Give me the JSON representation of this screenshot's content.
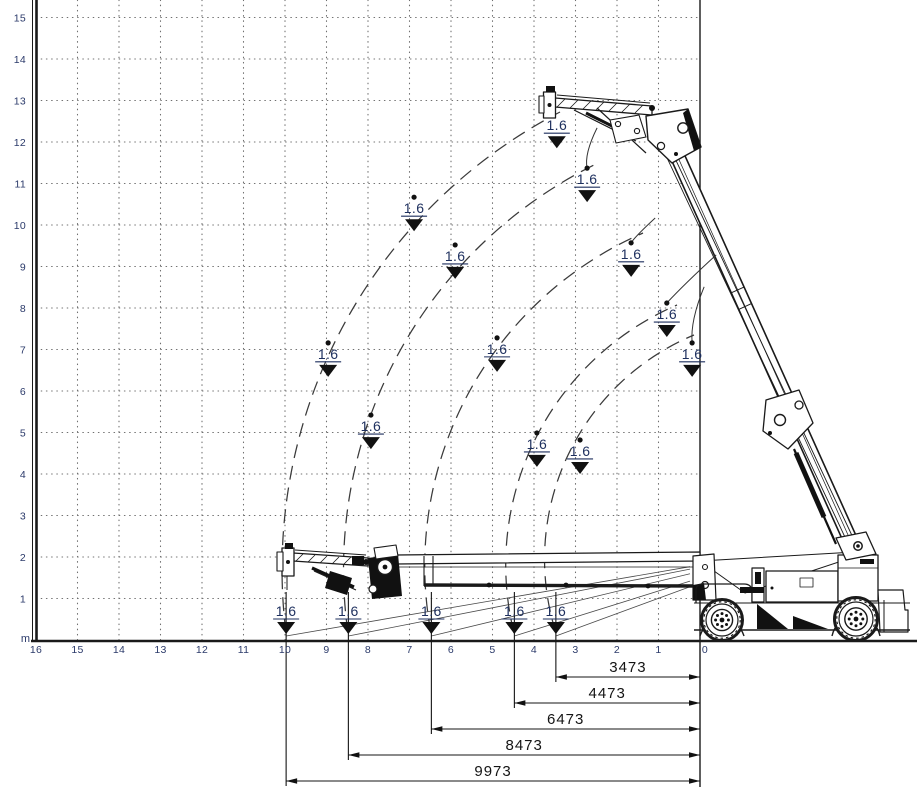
{
  "axes": {
    "unit_label": "m",
    "x_ticks": [
      "16",
      "15",
      "14",
      "13",
      "12",
      "11",
      "10",
      "9",
      "8",
      "7",
      "6",
      "5",
      "4",
      "3",
      "2",
      "1",
      "0"
    ],
    "y_ticks": [
      "15",
      "14",
      "13",
      "12",
      "11",
      "10",
      "9",
      "8",
      "7",
      "6",
      "5",
      "4",
      "3",
      "2",
      "1"
    ]
  },
  "layout": {
    "px_per_m": 41.5,
    "origin_x": 700,
    "origin_y": 640
  },
  "capacity_markers": [
    {
      "x_m": 3.45,
      "y_m": 12.67,
      "label": "1.6",
      "variant": "plain"
    },
    {
      "x_m": 2.72,
      "y_m": 11.37,
      "label": "1.6",
      "variant": "leader",
      "from_x_m": 2.48,
      "from_y_m": 12.34
    },
    {
      "x_m": 1.66,
      "y_m": 9.57,
      "label": "1.6",
      "variant": "leader",
      "from_x_m": 1.08,
      "from_y_m": 10.17
    },
    {
      "x_m": 0.8,
      "y_m": 8.12,
      "label": "1.6",
      "variant": "leader",
      "from_x_m": -0.39,
      "from_y_m": 9.28
    },
    {
      "x_m": 0.19,
      "y_m": 7.16,
      "label": "1.6",
      "variant": "leader",
      "from_x_m": -0.1,
      "from_y_m": 8.51
    },
    {
      "x_m": 6.89,
      "y_m": 10.67,
      "label": "1.6",
      "variant": "dot"
    },
    {
      "x_m": 5.9,
      "y_m": 9.52,
      "label": "1.6",
      "variant": "dot"
    },
    {
      "x_m": 8.96,
      "y_m": 7.16,
      "label": "1.6",
      "variant": "dot"
    },
    {
      "x_m": 4.89,
      "y_m": 7.28,
      "label": "1.6",
      "variant": "dot"
    },
    {
      "x_m": 7.93,
      "y_m": 5.42,
      "label": "1.6",
      "variant": "dot"
    },
    {
      "x_m": 3.93,
      "y_m": 4.99,
      "label": "1.6",
      "variant": "dot"
    },
    {
      "x_m": 2.89,
      "y_m": 4.82,
      "label": "1.6",
      "variant": "dot"
    },
    {
      "x_m": 9.973,
      "y_m": 0,
      "label": "1.6",
      "variant": "bottom"
    },
    {
      "x_m": 8.473,
      "y_m": 0,
      "label": "1.6",
      "variant": "bottom"
    },
    {
      "x_m": 6.473,
      "y_m": 0,
      "label": "1.6",
      "variant": "bottom"
    },
    {
      "x_m": 4.473,
      "y_m": 0,
      "label": "1.6",
      "variant": "bottom"
    },
    {
      "x_m": 3.473,
      "y_m": 0,
      "label": "1.6",
      "variant": "bottom"
    }
  ],
  "outreach_dimensions": [
    {
      "label": "3473",
      "mm": 3473
    },
    {
      "label": "4473",
      "mm": 4473
    },
    {
      "label": "6473",
      "mm": 6473
    },
    {
      "label": "8473",
      "mm": 8473
    },
    {
      "label": "9973",
      "mm": 9973
    }
  ],
  "chart_data": {
    "type": "scatter",
    "title": "",
    "x_axis": {
      "unit": "m",
      "range": [
        0,
        16
      ],
      "direction": "right-to-left",
      "grid": true
    },
    "y_axis": {
      "unit": "m",
      "range": [
        0,
        15
      ],
      "grid": true
    },
    "series": [
      {
        "name": "rated capacity (t) at jib-tip position",
        "points": [
          {
            "x_m": 3.45,
            "y_m": 12.67,
            "value": 1.6
          },
          {
            "x_m": 2.72,
            "y_m": 11.37,
            "value": 1.6
          },
          {
            "x_m": 1.66,
            "y_m": 9.57,
            "value": 1.6
          },
          {
            "x_m": 0.8,
            "y_m": 8.12,
            "value": 1.6
          },
          {
            "x_m": 0.19,
            "y_m": 7.16,
            "value": 1.6
          },
          {
            "x_m": 6.89,
            "y_m": 10.67,
            "value": 1.6
          },
          {
            "x_m": 5.9,
            "y_m": 9.52,
            "value": 1.6
          },
          {
            "x_m": 8.96,
            "y_m": 7.16,
            "value": 1.6
          },
          {
            "x_m": 4.89,
            "y_m": 7.28,
            "value": 1.6
          },
          {
            "x_m": 7.93,
            "y_m": 5.42,
            "value": 1.6
          },
          {
            "x_m": 3.93,
            "y_m": 4.99,
            "value": 1.6
          },
          {
            "x_m": 2.89,
            "y_m": 4.82,
            "value": 1.6
          },
          {
            "x_m": 9.973,
            "y_m": 0,
            "value": 1.6
          },
          {
            "x_m": 8.473,
            "y_m": 0,
            "value": 1.6
          },
          {
            "x_m": 6.473,
            "y_m": 0,
            "value": 1.6
          },
          {
            "x_m": 4.473,
            "y_m": 0,
            "value": 1.6
          },
          {
            "x_m": 3.473,
            "y_m": 0,
            "value": 1.6
          }
        ]
      }
    ],
    "annotations": {
      "outreach_mm": [
        3473,
        4473,
        6473,
        8473,
        9973
      ]
    },
    "legend": "none"
  }
}
